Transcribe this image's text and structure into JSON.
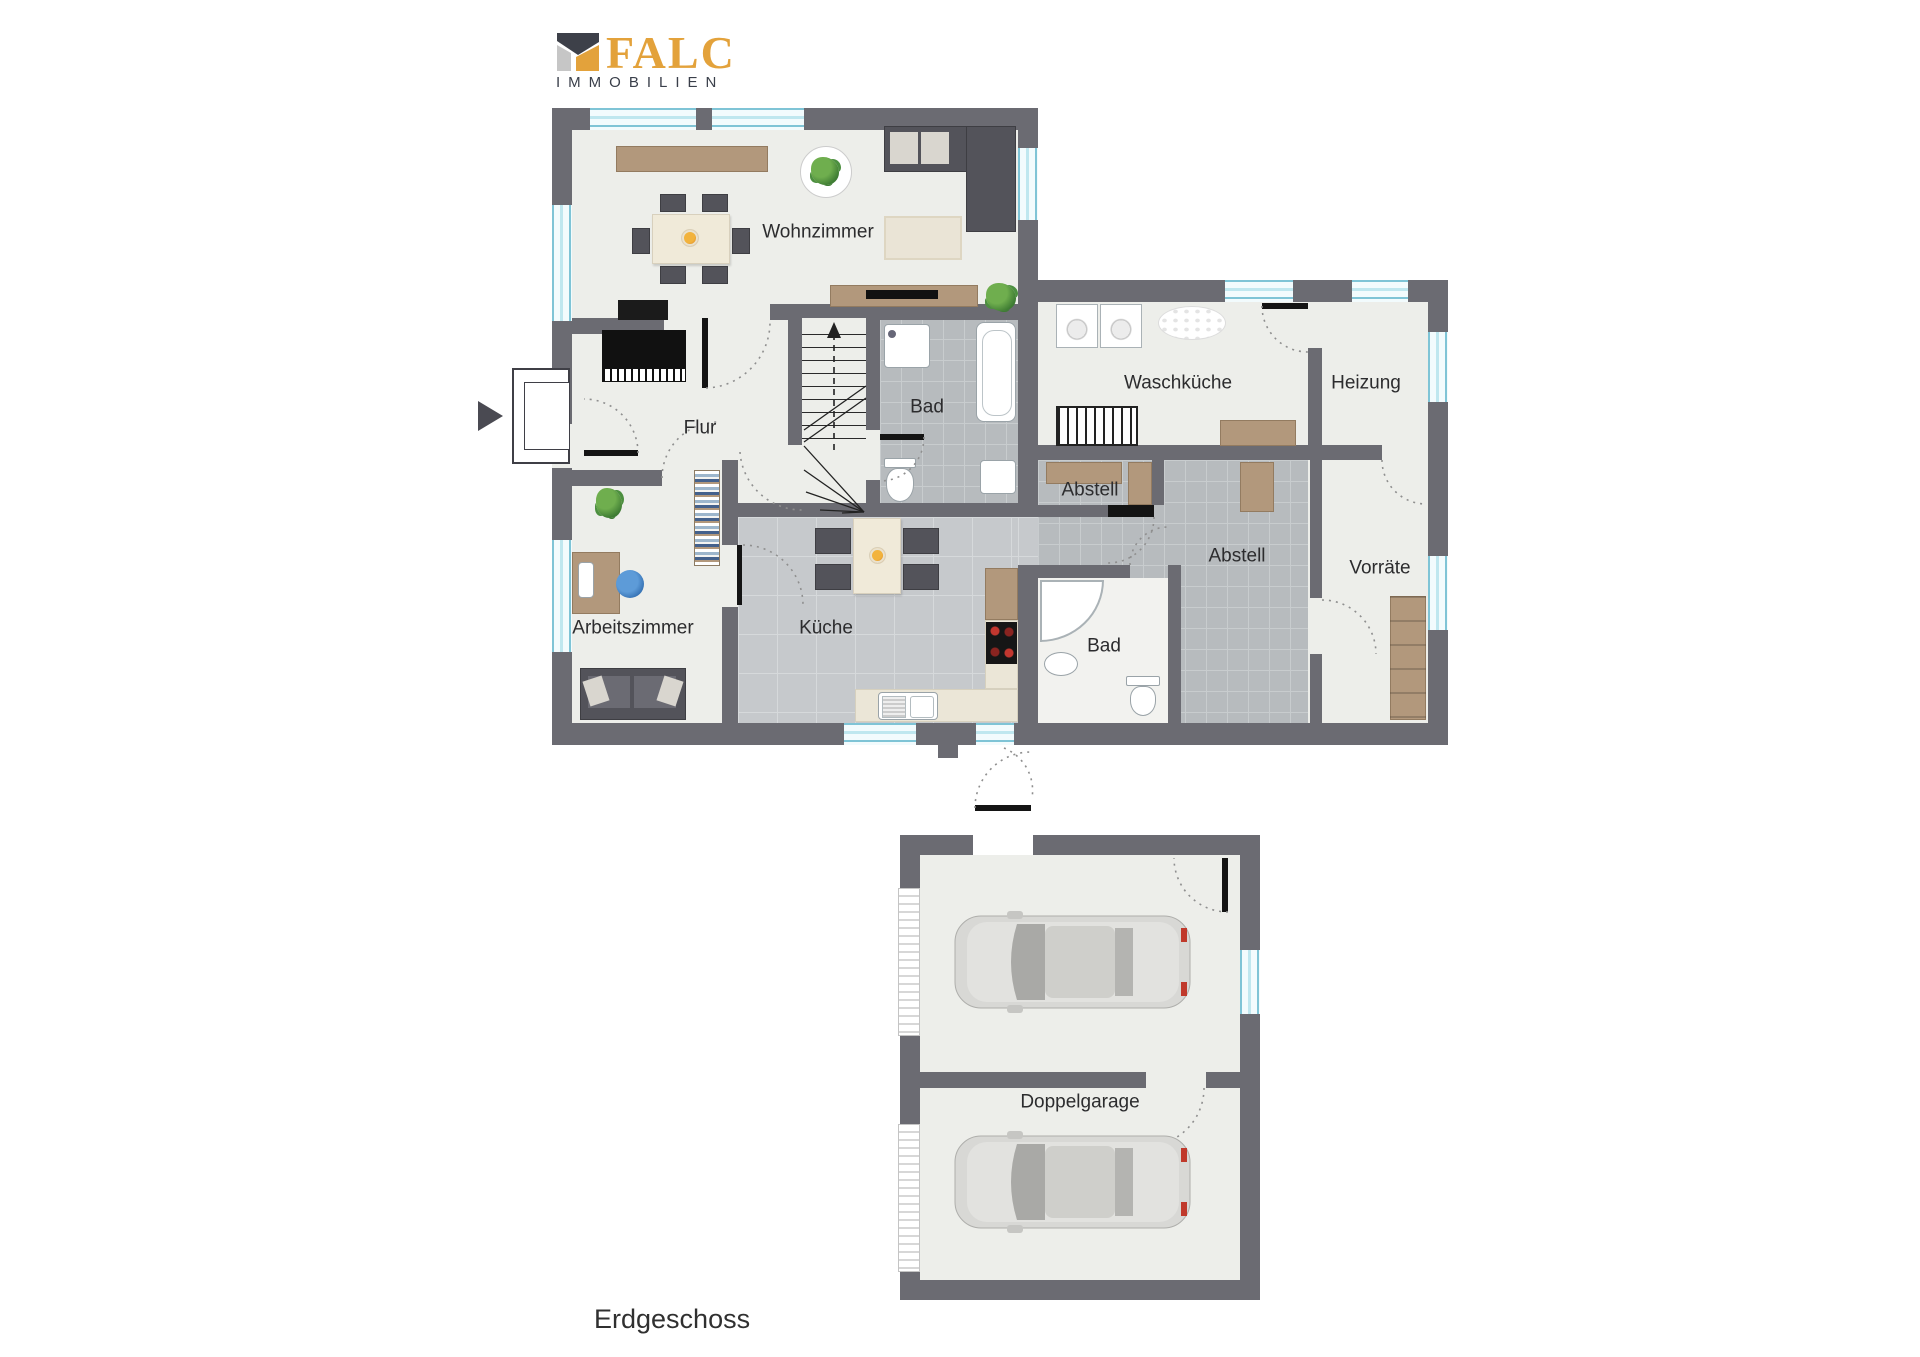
{
  "logo": {
    "brand": "FALC",
    "subtitle": "IMMOBILIEN"
  },
  "plan": {
    "floor_label": "Erdgeschoss",
    "room_labels": {
      "wohnzimmer": "Wohnzimmer",
      "flur": "Flur",
      "bad_top": "Bad",
      "waschkueche": "Waschküche",
      "heizung": "Heizung",
      "abstell_small": "Abstell",
      "abstell_large": "Abstell",
      "vorraete": "Vorräte",
      "arbeitszimmer": "Arbeitszimmer",
      "kueche": "Küche",
      "bad_bottom": "Bad",
      "garage": "Doppelgarage"
    },
    "icons": {
      "entrance": "entrance-arrow",
      "stairs_direction": "stairs-up-arrow"
    }
  },
  "colors": {
    "wall": "#6b6b72",
    "floor": "#edeeea",
    "tile_small": "#b7bbbe",
    "tile_large": "#c6c9cc",
    "wood": "#b2987c",
    "window_frame": "#7fc4d6",
    "brand_orange": "#E3A23B",
    "brand_text": "#3A3F4A",
    "label_text": "#2c2c2e"
  }
}
